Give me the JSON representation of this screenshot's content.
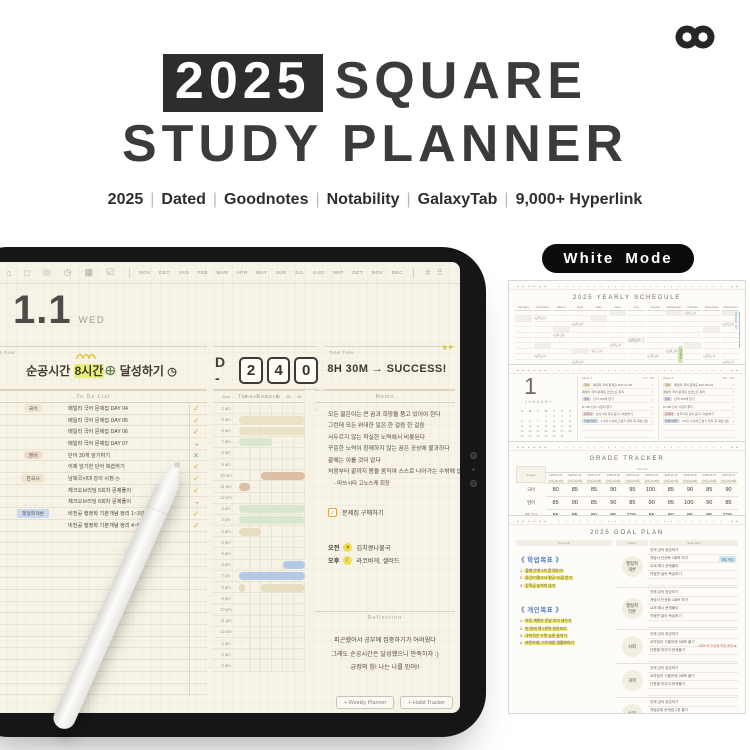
{
  "header": {
    "badge": "2025",
    "title_line1_rest": "SQUARE",
    "title_line2": "STUDY PLANNER",
    "subtitle_items": [
      "2025",
      "Dated",
      "Goodnotes",
      "Notability",
      "GalaxyTab",
      "9,000+ Hyperlink"
    ]
  },
  "tablet": {
    "toolbar": {
      "icons": [
        "⌂",
        "□",
        "◎",
        "◷",
        "▦",
        "☑"
      ],
      "icon_names": [
        "home",
        "calendar",
        "record",
        "clock",
        "stats",
        "checklist"
      ],
      "months": [
        "NOV",
        "DEC",
        "JAN",
        "FEB",
        "MAR",
        "APR",
        "MAY",
        "JUN",
        "JUL",
        "AUG",
        "SEP",
        "OCT",
        "NOV",
        "DEC"
      ],
      "right_icons": [
        "#",
        "⠿"
      ]
    },
    "date": {
      "day": "1.1",
      "weekday": "WED"
    },
    "today_goal": {
      "label": "Today's Goal",
      "pre": "순공시간 ",
      "highlight": "8시간",
      "plus": "⊕",
      "post": " 달성하기 ",
      "clock": "◷"
    },
    "dday": {
      "prefix": "D -",
      "digits": [
        "2",
        "4",
        "0"
      ]
    },
    "total_time": {
      "label": "Total Time",
      "value": "8H 30M → SUCCESS!",
      "stars": "★✦"
    },
    "todo": {
      "header": "To Do List",
      "items": [
        {
          "tag": "국어",
          "tag_style": "beige",
          "text": "매일리 국어 문제집 DAY 04",
          "mark": "check"
        },
        {
          "tag": "",
          "tag_style": "",
          "text": "매일리 국어 문제집 DAY 05",
          "mark": "check"
        },
        {
          "tag": "",
          "tag_style": "",
          "text": "매일리 국어 문제집 DAY 06",
          "mark": "check"
        },
        {
          "tag": "",
          "tag_style": "",
          "text": "매일리 국어 문제집 DAY 07",
          "mark": "arrow"
        },
        {
          "tag": "영어",
          "tag_style": "pink",
          "text": "단어 30개 암기하기",
          "mark": "x"
        },
        {
          "tag": "",
          "tag_style": "",
          "text": "어제 암기한 단어 복습하기",
          "mark": "check"
        },
        {
          "tag": "한국사",
          "tag_style": "beige",
          "text": "남북국시대 강의 시청 ◷",
          "mark": "check"
        },
        {
          "tag": "",
          "tag_style": "",
          "text": "체크오브리딩 5회차 문제풀이",
          "mark": "check"
        },
        {
          "tag": "",
          "tag_style": "",
          "text": "체크오브리딩 6회차 문제풀이",
          "mark": "arrow"
        },
        {
          "tag": "행정학개론",
          "tag_style": "blue",
          "text": "비전공 행정학 기본개념 정리 1~3강 복습 ◷",
          "mark": "check"
        },
        {
          "tag": "",
          "tag_style": "",
          "text": "비전공 행정학 기본개념 정리 4~5강 복습 ◷",
          "mark": "check"
        }
      ],
      "empty_rows": 14
    },
    "time_record": {
      "header": "Time Record",
      "hour_label": "Hour",
      "minutes": [
        "10",
        "20",
        "30",
        "40",
        "50",
        "60"
      ],
      "rows": [
        {
          "label": "4 am",
          "bars": []
        },
        {
          "label": "5 am",
          "bars": [
            [
              0,
              6,
              "beige"
            ]
          ]
        },
        {
          "label": "6 am",
          "bars": [
            [
              0,
              6,
              "beige"
            ]
          ]
        },
        {
          "label": "7 am",
          "bars": [
            [
              0,
              3,
              "green"
            ]
          ]
        },
        {
          "label": "8 am",
          "bars": []
        },
        {
          "label": "9 am",
          "bars": []
        },
        {
          "label": "10 am",
          "bars": [
            [
              2,
              6,
              "tan"
            ]
          ]
        },
        {
          "label": "11 am",
          "bars": [
            [
              0,
              1,
              "tan"
            ]
          ]
        },
        {
          "label": "12 pm",
          "bars": []
        },
        {
          "label": "1 pm",
          "bars": [
            [
              0,
              6,
              "green"
            ]
          ]
        },
        {
          "label": "2 pm",
          "bars": [
            [
              0,
              6,
              "green"
            ]
          ]
        },
        {
          "label": "3 pm",
          "bars": [
            [
              0,
              2,
              "khaki"
            ]
          ]
        },
        {
          "label": "4 pm",
          "bars": []
        },
        {
          "label": "5 pm",
          "bars": []
        },
        {
          "label": "6 pm",
          "bars": [
            [
              4,
              6,
              "blue"
            ]
          ]
        },
        {
          "label": "7 pm",
          "bars": [
            [
              0,
              6,
              "blue"
            ]
          ]
        },
        {
          "label": "8 pm",
          "bars": [
            [
              0,
              0.5,
              "khaki"
            ],
            [
              2,
              6,
              "khaki"
            ]
          ]
        },
        {
          "label": "9 pm",
          "bars": []
        },
        {
          "label": "10 pm",
          "bars": []
        },
        {
          "label": "11 pm",
          "bars": []
        },
        {
          "label": "12 am",
          "bars": []
        },
        {
          "label": "1 am",
          "bars": []
        },
        {
          "label": "2 am",
          "bars": []
        },
        {
          "label": "3 am",
          "bars": []
        }
      ]
    },
    "memo": {
      "header": "Memo",
      "quote_lines": [
        "모든 젊은이는 큰 꿈과 희망을 품고 있어야 한다",
        "그런데 모든 위대한 일은 한 걸음 한 걸음",
        "서두르지 않는 착실한 노력에서 비롯된다",
        "꾸준한 노력이 함께하지 않는 꿈은 공상에 불과하다",
        "끝에는 이룰 것이 없다",
        "처음부터 끝까지 몸을 움직여 스스로 나아가는 수밖에 없다 ”"
      ],
      "quote_source": "- 마쓰시타 고노스케 회장",
      "checkbox_item": "문제집 구매하기",
      "morning_label": "오전",
      "morning_icon": "☀",
      "morning_text": "김치콩나물국",
      "evening_label": "오후",
      "evening_icon": "☾",
      "evening_text": "라코바게, 샐러드"
    },
    "reflection": {
      "header": "Reflection",
      "lines": [
        "피곤했어서 공부에 집중하기가 어려웠다",
        "그래도 순공시간은 달성했으니 만족하자 :)",
        "긍정의 힘! 나는 나를 믿어!!"
      ]
    },
    "footer_buttons": [
      "+ Weekly Planner",
      "+ Habit Tracker"
    ]
  },
  "right_panel": {
    "mode_badge": "White Mode",
    "yearly": {
      "title": "2025 YEARLY SCHEDULE",
      "months": [
        "January",
        "February",
        "March",
        "April",
        "May",
        "June",
        "July",
        "August",
        "September",
        "October",
        "November",
        "December"
      ],
      "note_text": "+모의고사",
      "note_cells": [
        [
          1,
          1
        ],
        [
          9,
          0
        ],
        [
          3,
          2
        ],
        [
          2,
          4
        ],
        [
          11,
          2
        ],
        [
          6,
          5
        ],
        [
          5,
          6
        ],
        [
          8,
          7
        ],
        [
          1,
          8
        ],
        [
          7,
          8
        ],
        [
          10,
          8
        ],
        [
          3,
          9
        ],
        [
          11,
          9
        ]
      ],
      "gray_cells": [
        [
          0,
          1
        ],
        [
          2,
          3
        ],
        [
          4,
          1
        ],
        [
          5,
          0
        ],
        [
          6,
          5
        ],
        [
          8,
          0
        ],
        [
          9,
          6
        ],
        [
          10,
          3
        ],
        [
          11,
          0
        ],
        [
          1,
          6
        ],
        [
          3,
          7
        ]
      ],
      "red_note": {
        "month": 4,
        "row": 7,
        "text": "<중간고사>"
      },
      "green_note": {
        "month": 8,
        "text": "겨울특강"
      },
      "blue_note": {
        "month": 11,
        "text": "겨울방학 시작"
      }
    },
    "monthly": {
      "big_number": "1",
      "month_label": "JANUARY",
      "cal_header": [
        "S",
        "M",
        "T",
        "W",
        "T",
        "F",
        "S"
      ],
      "first_weekday": 3,
      "num_days": 31,
      "weeks": [
        {
          "label": "Week 1",
          "range": "1/1 - 1/5",
          "items": [
            {
              "tag": "국어",
              "tag_style": "yellow",
              "text": "매일리 국어 문제집 DAY 01-05",
              "mark": "check"
            },
            {
              "tag": "",
              "tag_style": "",
              "text": "매일리 국어 문제집 오답노트 정리",
              "mark": "check"
            },
            {
              "tag": "영어",
              "tag_style": "lavender",
              "text": "단어 150개 암기",
              "mark": "check"
            },
            {
              "tag": "",
              "tag_style": "",
              "text": "D-100 단어 시험지 풀기",
              "mark": "arrow"
            },
            {
              "tag": "한국사",
              "tag_style": "rose",
              "text": "선사시대 강의 듣기 / 복습하기",
              "mark": "check"
            },
            {
              "tag": "행정학개론",
              "tag_style": "blue",
              "text": "1-3강 수강하고 필기 정리 후 복습 (완)",
              "mark": "check"
            }
          ]
        },
        {
          "label": "Week 2",
          "range": "1/6 - 1/12",
          "items": [
            {
              "tag": "국어",
              "tag_style": "yellow",
              "text": "매일리 국어 문제집 DAY 06-10",
              "mark": "check"
            },
            {
              "tag": "",
              "tag_style": "",
              "text": "매일리 국어 문제집 오답노트 정리",
              "mark": "check"
            },
            {
              "tag": "영어",
              "tag_style": "lavender",
              "text": "단어 150개 암기",
              "mark": "check"
            },
            {
              "tag": "",
              "tag_style": "",
              "text": "D-100 단어 시험지 풀기",
              "mark": "check"
            },
            {
              "tag": "한국사",
              "tag_style": "rose",
              "text": "삼국시대 강의 듣기 / 복습하기",
              "mark": "check"
            },
            {
              "tag": "행정학개론",
              "tag_style": "blue",
              "text": "4-6강 수강하고 필기 정리 후 복습 (완)",
              "mark": "check"
            }
          ]
        }
      ]
    },
    "grade": {
      "title": "GRADE TRACKER",
      "corner_label": "Subject",
      "group_label": "Test Info",
      "dates": [
        "2025.01.05",
        "2025.01.14",
        "2025.01.27",
        "2025.02.09",
        "2025.02.23",
        "2025.03.09",
        "2025.03.16",
        "2025.03.30",
        "2025.04.13",
        "2025.04.27"
      ],
      "exam_labels": [
        "모의고사 1회",
        "모의고사 2회",
        "모의고사 3회",
        "모의고사 4회",
        "모의고사 5회",
        "모의고사 6회",
        "모의고사 7회",
        "모의고사 8회",
        "모의고사 9회",
        "모의고사 10회"
      ],
      "rows": [
        {
          "subject": "국어",
          "scores": [
            80,
            85,
            85,
            90,
            95,
            100,
            85,
            90,
            85,
            90
          ]
        },
        {
          "subject": "영어",
          "scores": [
            85,
            90,
            85,
            90,
            85,
            90,
            95,
            100,
            90,
            85
          ]
        },
        {
          "subject": "한국사",
          "scores": [
            85,
            85,
            80,
            85,
            100,
            85,
            80,
            85,
            85,
            100
          ]
        }
      ]
    },
    "goal_plan": {
      "title": "2025 GOAL PLAN",
      "left_header": "My Goals",
      "subject_header": "Subject",
      "plan_header": "Study Plan",
      "academic_title": "《 학업목표 》",
      "academic_items": [
        "1.  올해 안에 1차 합격하기!",
        "2.  중간/기말고사 평균 90점 받기",
        "3.  장학금 놓치지 않기"
      ],
      "personal_title": "《 개인목표 》",
      "personal_items": [
        "1.  하루 계획은 전날 미리 세우기",
        "2.  한 달에 책 2권씩 읽어보기",
        "3.  규칙적인 수면 습관 들이기",
        "4.  바른자세, 스트레칭 생활화하기"
      ],
      "subjects": [
        {
          "name": "행정학\n개론",
          "plans": [
            "전체 강의 완강하기",
            "개념서 단권화 1회독 하기",
            "교재 예시 문제풀이",
            "약점만 골라 복습하기"
          ],
          "blue_note": "매일 복습"
        },
        {
          "name": "행정학\n각론",
          "plans": [
            "전체 강의 완강하기",
            "개념서 단권화 1회독 하기",
            "교재 예시 문제풀이",
            "약점만 골라 복습하기"
          ]
        },
        {
          "name": "사회",
          "plans": [
            "전체 강의 완강하기",
            "요약정리 기출문제 3회독 풀기",
            "단원별 마무리 문제풀기"
          ],
          "red_note": "← 1회독 후 단권화 작업 예정 ★"
        },
        {
          "name": "과학",
          "plans": [
            "전체 강의 완강하기",
            "요약정리 기출문제 3회독 풀기",
            "단원별 마무리 문제풀기"
          ]
        },
        {
          "name": "수학",
          "plans": [
            "전체 강의 완강하기",
            "개념유형 문제집 2권 풀기"
          ]
        },
        {
          "name": "-",
          "plans": []
        }
      ]
    }
  },
  "colors": {
    "accent_orange": "#d9a13c",
    "arrow_red": "#a6523d",
    "x_teal": "#7aa8a0",
    "bar_beige": "#e9e2c4",
    "bar_green": "#d9e7d0",
    "bar_tan": "#ddbfa4",
    "bar_khaki": "#e6dec0",
    "bar_blue": "#b4c9e6",
    "highlight_yellow": "#e7ef7a",
    "screen_bg": "#f7f3e7"
  }
}
